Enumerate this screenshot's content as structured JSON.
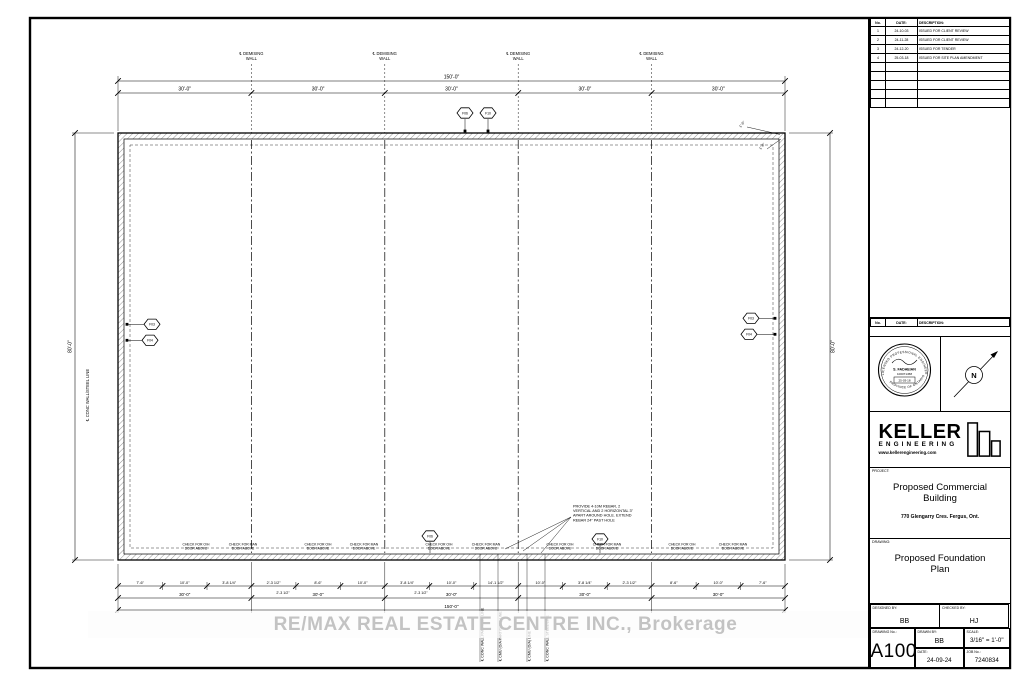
{
  "watermark": "RE/MAX REAL ESTATE CENTRE INC., Brokerage",
  "revisions": {
    "no_h": "No.",
    "date_h": "DATE:",
    "desc_h": "DESCRIPTION:",
    "rows": [
      {
        "no": "1",
        "date": "24-10-03",
        "desc": "ISSUED FOR CLIENT REVIEW"
      },
      {
        "no": "2",
        "date": "24-11-28",
        "desc": "ISSUED FOR CLIENT REVIEW"
      },
      {
        "no": "3",
        "date": "24-12-20",
        "desc": "ISSUED FOR TENDER"
      },
      {
        "no": "4",
        "date": "25-03-18",
        "desc": "ISSUED FOR SITE PLAN AMENDMENT"
      }
    ]
  },
  "stamp": {
    "top_arc": "LICENSED PROFESSIONAL ENGINEER",
    "name": "S. FADAEIAN",
    "license": "100071458",
    "date": "25-03-18",
    "bottom_arc": "PROVINCE OF ONTARIO"
  },
  "north_label": "N",
  "firm": {
    "name": "KELLER",
    "tagline": "ENGINEERING",
    "website": "www.kellerengineering.com"
  },
  "project": {
    "label": "PROJECT:",
    "title_line1": "Proposed Commercial",
    "title_line2": "Building",
    "address": "770 Glengarry Cres. Fergus, Ont."
  },
  "drawing": {
    "label": "DRAWING:",
    "title_line1": "Proposed Foundation",
    "title_line2": "Plan"
  },
  "block": {
    "designed_label": "DESIGNED BY:",
    "designed": "BB",
    "checked_label": "CHECKED BY:",
    "checked": "HJ",
    "drawn_label": "DRAWN BY:",
    "drawn": "BB",
    "scale_label": "SCALE:",
    "scale": "3/16\" = 1'-0\"",
    "date_label": "DATE:",
    "date": "24-09-24",
    "job_label": "JOB No.:",
    "job": "7240834",
    "dwg_label": "DRAWING No.:",
    "dwg": "A100"
  },
  "plan": {
    "overall_width": "150'-0\"",
    "bay_width": "30'-0\"",
    "overall_depth": "80'-0\"",
    "demising_l1": "℄ DEMISING",
    "demising_l2": "WALL",
    "cl_wall_label": "℄ CONC WALL/STEEL LINE",
    "corner_offset": "1'-0\"",
    "keynotes": {
      "f03": "F03",
      "f04": "F04",
      "f06": "F06",
      "f10": "F10"
    },
    "note_l1": "PROVIDE 4-10M REBAR, 2",
    "note_l2": "VERTICAL AND 2 HORIZONTAL 3\"",
    "note_l3": "APART AROUND HOLE. EXTEND",
    "note_l4": "REBAR 24\" PAST HOLE",
    "check_oh_l1": "CHECK FOR O/H",
    "check_oh_l2": "DOOR ABOVE",
    "check_man_l1": "CHECK FOR MAN",
    "check_man_l2": "DOOR ABOVE",
    "detail_dims": [
      "7'-6\"",
      "10'-0\"",
      "3'-8 1/4\"",
      "2'-3 1/2\"",
      "8'-6\"",
      "10'-0\"",
      "3'-8 1/4\"",
      "10'-0\"",
      "14'-1 1/2\"",
      "10'-0\"",
      "3'-8 1/4\"",
      "2'-3 1/2\"",
      "8'-6\"",
      "10'-0\"",
      "7'-6\""
    ],
    "sub_dim": "2'-3 1/2\"",
    "cl_lines": [
      "℄ CONC WALL PARTITION LINE",
      "℄ CMU (O/A PARTITION) LINE",
      "℄ CMU (O/A) LINE",
      "℄ CONC WALL STEEL LINE"
    ]
  }
}
